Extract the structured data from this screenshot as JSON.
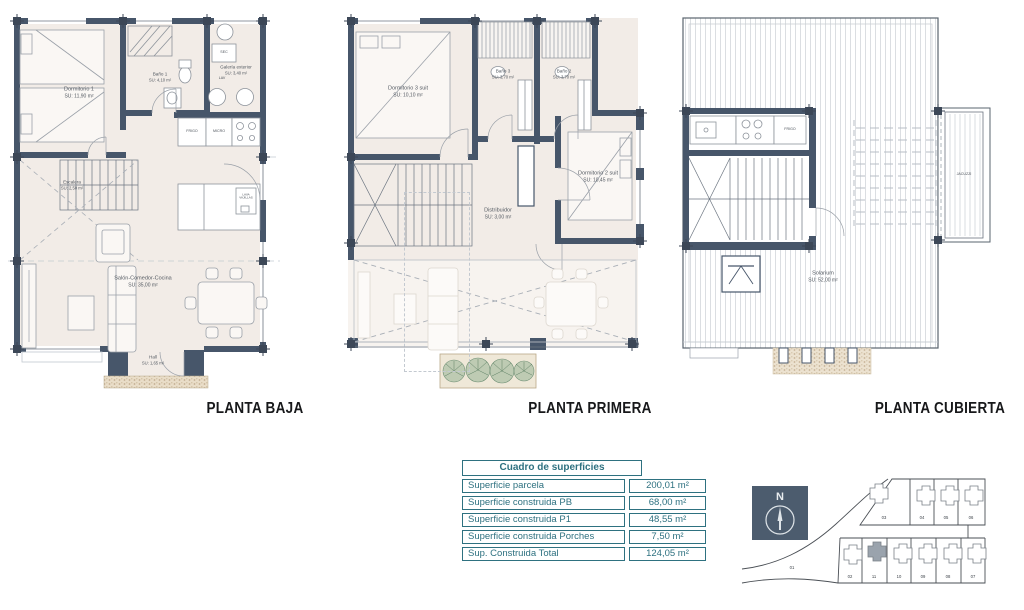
{
  "colors": {
    "wall": "#47566a",
    "floor": "#f2ece7",
    "accent_teal": "#2e7180",
    "highlight_gray": "#9aa3ad"
  },
  "plans": [
    {
      "title": "PLANTA BAJA",
      "rooms": [
        {
          "name": "Dormitorio 1",
          "area": "SU: 11,90 m²"
        },
        {
          "name": "Baño 1",
          "area": "SU: 4,10 m²"
        },
        {
          "name": "Galería exterior",
          "area": "SU: 3,40 m²"
        },
        {
          "name": "Escalera",
          "area": "SU: 2,50 m²"
        },
        {
          "name": "Salón-Comedor-Cocina",
          "area": "SU: 35,00 m²"
        },
        {
          "name": "Hall",
          "area": "SU: 1,65 m²"
        }
      ],
      "appliances": {
        "fridge": "FRIGO",
        "microwave": "MICRO",
        "dryer": "SEC",
        "washer": "LAV",
        "dishwasher": "LAVA VAJILLAS"
      }
    },
    {
      "title": "PLANTA PRIMERA",
      "rooms": [
        {
          "name": "Dormitorio 3 suit",
          "area": "SU: 10,10 m²"
        },
        {
          "name": "Baño 3",
          "area": "SU: 3,70 m²"
        },
        {
          "name": "Baño 2",
          "area": "SU: 3,70 m²"
        },
        {
          "name": "Dormitorio 2 suit",
          "area": "SU: 10,45 m²"
        },
        {
          "name": "Distribuidor",
          "area": "SU: 3,00 m²"
        }
      ]
    },
    {
      "title": "PLANTA CUBIERTA",
      "rooms": [
        {
          "name": "Solarium",
          "area": "SU: 52,00 m²"
        }
      ],
      "appliances": {
        "fridge": "FRIGO",
        "jacuzzi": "JACUZZI"
      }
    }
  ],
  "surfaces_table": {
    "header": "Cuadro de superficies",
    "rows": [
      {
        "label": "Superficie parcela",
        "value": "200,01 m²"
      },
      {
        "label": "Superficie construida PB",
        "value": "68,00 m²"
      },
      {
        "label": "Superficie construida P1",
        "value": "48,55 m²"
      },
      {
        "label": "Superficie construida Porches",
        "value": "7,50 m²"
      },
      {
        "label": "Sup. Construida Total",
        "value": "124,05 m²"
      }
    ]
  },
  "compass": {
    "north_label": "N"
  },
  "siteplan": {
    "plots_top": [
      "03",
      "04",
      "05",
      "06"
    ],
    "plots_bottom": [
      "02",
      "11",
      "10",
      "09",
      "08",
      "07"
    ],
    "road_plot": "01",
    "highlighted_plot": "11"
  }
}
